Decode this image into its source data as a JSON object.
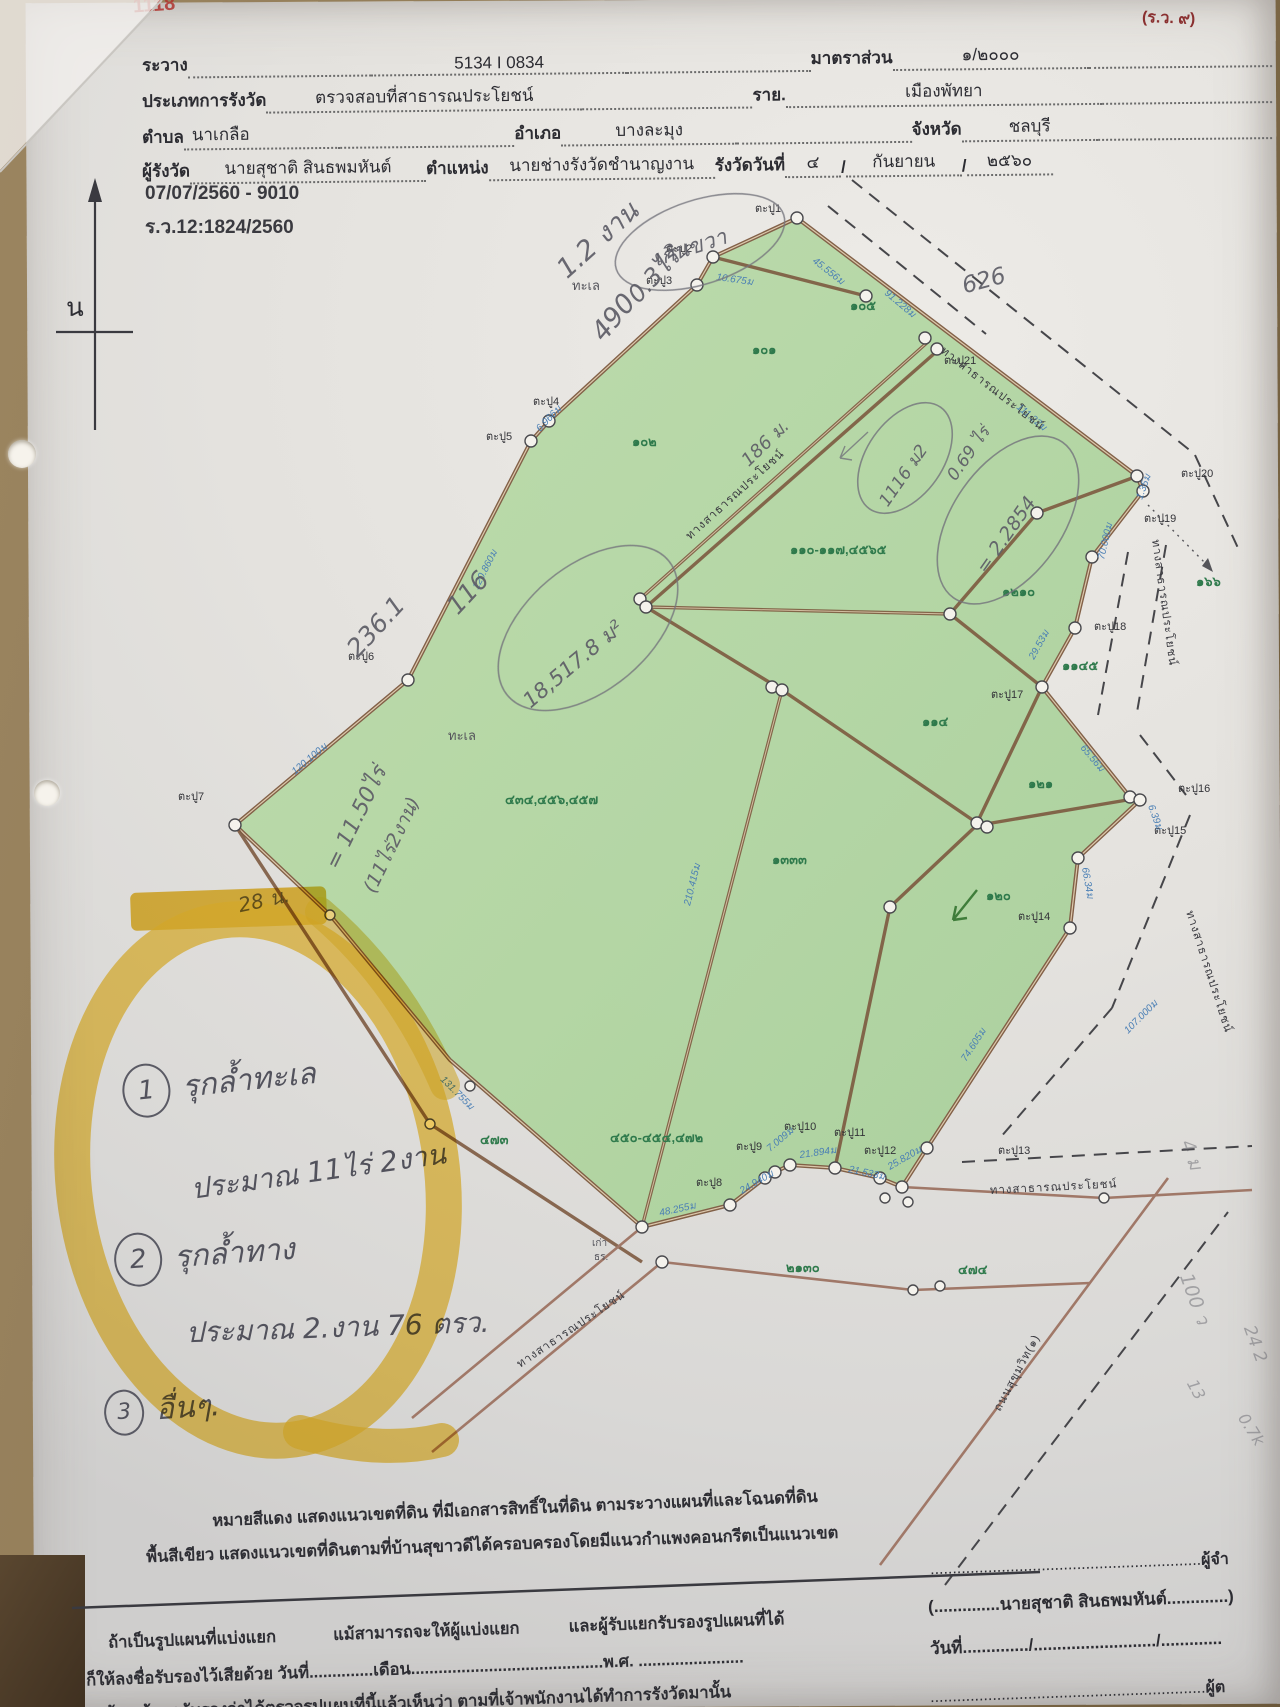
{
  "doc": {
    "form_code": "(ร.ว. ๙)",
    "stamp": "1118",
    "north_letter": "น",
    "ref1": "07/07/2560 - 9010",
    "ref2": "ร.ว.12:1824/2560"
  },
  "header": {
    "row1": {
      "l1": "ระวาง",
      "v1": "5134 I 0834",
      "l2": "มาตราส่วน",
      "v2": "๑/๒๐๐๐"
    },
    "row2": {
      "l1": "ประเภทการรังวัด",
      "v1": "ตรวจสอบที่สาธารณประโยชน์",
      "l2": "ราย.",
      "v2": "เมืองพัทยา"
    },
    "row3": {
      "l1": "ตำบล",
      "v1": "นาเกลือ",
      "l2": "อำเภอ",
      "v2": "บางละมุง",
      "l3": "จังหวัด",
      "v3": "ชลบุรี"
    },
    "row4": {
      "l1": "ผู้รังวัด",
      "v1": "นายสุชาติ สินธพมหันต์",
      "l2": "ตำแหน่ง",
      "v2": "นายช่างรังวัดชำนาญงาน",
      "l3": "รังวัดวันที่",
      "v3": "๔",
      "v4": "กันยายน",
      "v5": "๒๕๖๐"
    }
  },
  "map": {
    "sea1": "ทะเล",
    "sea2": "ทะเล",
    "old1": "เก่า",
    "old2": "ธร.",
    "plots": [
      {
        "label": "๑๐๕"
      },
      {
        "label": "๑๐๑"
      },
      {
        "label": "๑๐๒"
      },
      {
        "label": "๑๑๐-๑๑๗,๔๕๖๕"
      },
      {
        "label": "๔๓๔,๔๕๖,๔๕๗"
      },
      {
        "label": "๑๓๓๓"
      },
      {
        "label": "๔๕๐-๔๕๔,๔๗๒"
      },
      {
        "label": "๑๒๑๐"
      },
      {
        "label": "๑๑๔"
      },
      {
        "label": "๑๒๑"
      },
      {
        "label": "๑๒๐"
      },
      {
        "label": "๑๑๔๕"
      },
      {
        "label": "๑๖๖"
      },
      {
        "label": "๔๗๓"
      },
      {
        "label": "๒๑๓๐"
      },
      {
        "label": "๔๗๔"
      }
    ],
    "pins": [
      "ตะปู1",
      "ตะปู2",
      "ตะปู3",
      "ตะปู4",
      "ตะปู5",
      "ตะปู6",
      "ตะปู7",
      "ตะปู8",
      "ตะปู9",
      "ตะปู10",
      "ตะปู11",
      "ตะปู12",
      "ตะปู13",
      "ตะปู14",
      "ตะปู15",
      "ตะปู16",
      "ตะปู17",
      "ตะปู18",
      "ตะปู19",
      "ตะปู20",
      "ตะปู21"
    ],
    "edges": [
      "45.556ม",
      "10.675ม",
      "91.228ม",
      "111.22ม",
      "6.966ม",
      "120.860ม",
      "120.100ม",
      "131.755ม",
      "48.255ม",
      "24.940ม",
      "7.009ม",
      "21.894ม",
      "21.533ม",
      "25.820ม",
      "74.605ม",
      "66.34ม",
      "6.39ม",
      "65.56ม",
      "29.53ม",
      "70.000ม",
      "1.35ม",
      "107.000ม",
      "210.415ม"
    ],
    "roads": [
      "ทางสาธารณประโยชน์",
      "ทางสาธารณประโยชน์",
      "ทางสาธารณประโยชน์",
      "ทางสาธารณประโยชน์",
      "ทางสาธารณประโยชน์",
      "ทางสาธารณประโยชน์",
      "ถนนสุขุมวิท(๑)"
    ]
  },
  "pencil": [
    "1.2 งาน",
    "0.3ไร่",
    "เกินขวา",
    "490",
    "626",
    "236.1",
    "116",
    "18,517.8 ม²",
    "= 11.50ไร่",
    "(11ไร่2งาน)",
    "28 น.",
    "186 ม.",
    "1116 ม2",
    "0.69 ไร่",
    "= 2.2854",
    "4 ม",
    "100 ว",
    "24 2",
    "13",
    "0.7k"
  ],
  "notes": {
    "n1_num": "1",
    "n1": "รุกล้ำทะเล",
    "n1b": "ประมาณ 11ไร่ 2งาน",
    "n2_num": "2",
    "n2": "รุกล้ำทาง",
    "n2b": "ประมาณ 2.งาน 76 ตรว.",
    "n3_num": "3",
    "n3": "อื่นๆ."
  },
  "legend": {
    "line1": "หมายสีแดง  แสดงแนวเขตที่ดิน ที่มีเอกสารสิทธิ์ในที่ดิน ตามระวางแผนที่และโฉนดที่ดิน",
    "line2": "พื้นสีเขียว แสดงแนวเขตที่ดินตามที่บ้านสุขาวดีได้ครอบครองโดยมีแนวกำแพงคอนกรีตเป็นแนวเขต"
  },
  "footer": {
    "r1a": "ถ้าเป็นรูปแผนที่แบ่งแยก",
    "r1b": "แม้สามารถจะให้ผู้แบ่งแยก",
    "r1c": "และผู้รับแยกรับรองรูปแผนที่ได้",
    "r2a": "ก็ให้ลงชื่อรับรองไว้เสียด้วย  วันที่",
    "r2b": "เดือน",
    "r2c": "พ.ศ.",
    "r3": "ข้าพเจ้าขอรับรองว่าได้ตรวจรูปแผนที่นี้แล้วเห็นว่า ตามที่เจ้าพนักงานได้ทำการรังวัดมานั้น"
  },
  "signature": {
    "role1": "ผู้จำ",
    "name": "(..............นายสุชาติ สินธพมหันต์.............)",
    "date_line": "วันที่............../........................../.............",
    "role2": "ผู้ต"
  },
  "colors": {
    "parcel_green": "#b5d8a5",
    "boundary_brown": "#7d5a40",
    "edge_blue": "#4a7fb5",
    "plot_green_text": "#2f7a4c",
    "highlighter": "#f2c230",
    "stam_red": "#a8322b"
  }
}
